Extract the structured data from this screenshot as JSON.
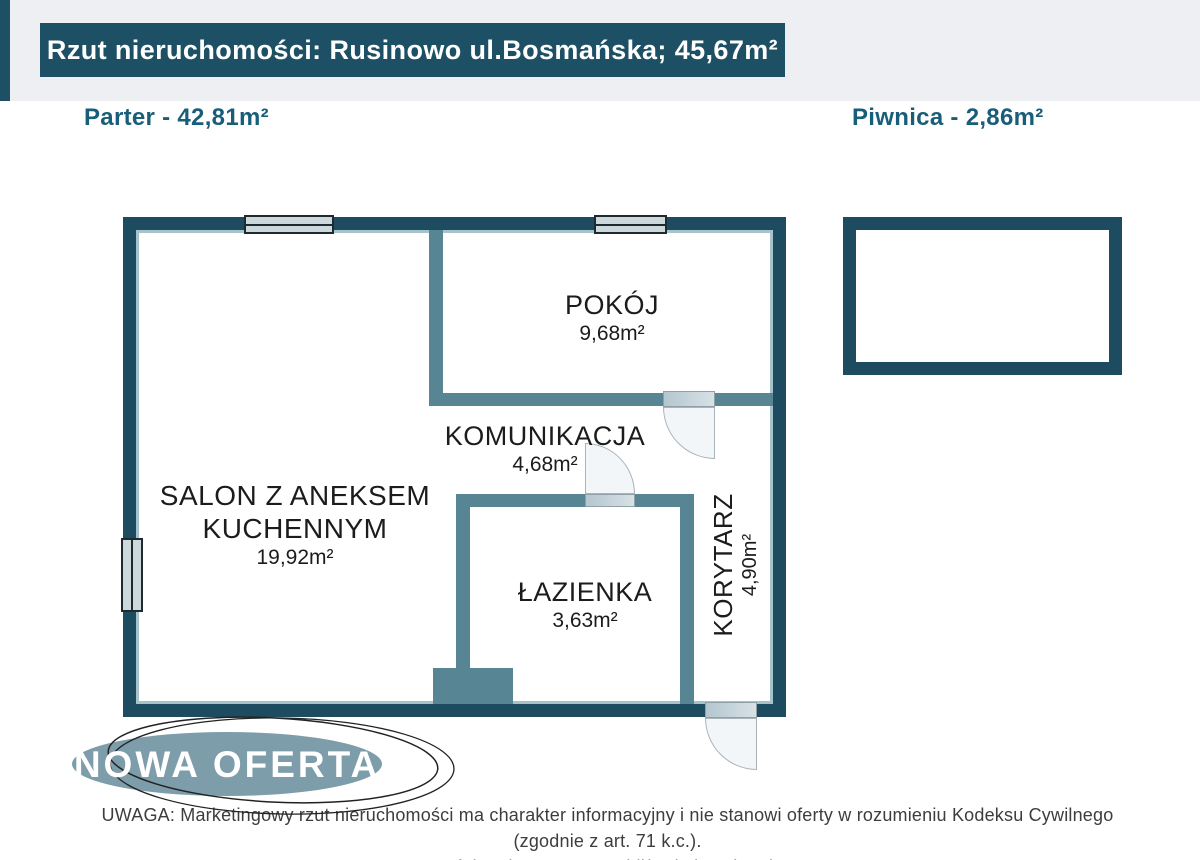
{
  "header": {
    "title": "Rzut nieruchomości: Rusinowo ul.Bosmańska; 45,67m²"
  },
  "floor_labels": {
    "parter": "Parter - 42,81m²",
    "piwnica": "Piwnica - 2,86m²"
  },
  "rooms": {
    "salon": {
      "name_line1": "SALON Z ANEKSEM",
      "name_line2": "KUCHENNYM",
      "area": "19,92m²"
    },
    "pokoj": {
      "name": "POKÓJ",
      "area": "9,68m²"
    },
    "komunikacja": {
      "name": "KOMUNIKACJA",
      "area": "4,68m²"
    },
    "lazienka": {
      "name": "ŁAZIENKA",
      "area": "3,63m²"
    },
    "korytarz": {
      "name": "KORYTARZ",
      "area": "4,90m²"
    }
  },
  "stamp": {
    "text": "NOWA OFERTA",
    "fill": "#7e9dab"
  },
  "disclaimer": {
    "line1": "UWAGA: Marketingowy rzut nieruchomości ma charakter informacyjny i nie stanowi oferty w rozumieniu Kodeksu Cywilnego (zgodnie z art. 71 k.c.).",
    "line2": "Wartości podane są w przybliżeniu i zaokrąglone."
  },
  "colors": {
    "wall": "#1d4c60",
    "partition": "#578594",
    "header_bg": "#1d5064",
    "floor_label_text": "#195e79",
    "window_fill": "#ccd8dc",
    "top_band": "#edeff3",
    "stamp_fill": "#7e9dab"
  }
}
